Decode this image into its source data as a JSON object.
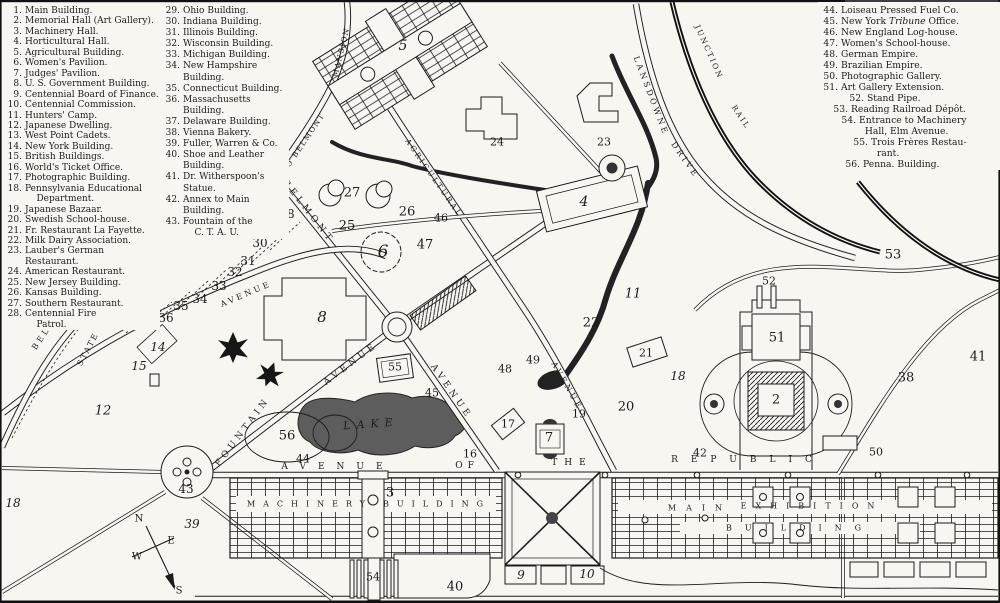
{
  "colors": {
    "ink": "#1c1c1c",
    "paper": "#f7f6f1",
    "water": "#3c3c3c",
    "lake": "#5d5d5d"
  },
  "legend": {
    "col1": [
      {
        "n": "1.",
        "t": "Main Building."
      },
      {
        "n": "2.",
        "t": "Memorial Hall (Art Gallery)."
      },
      {
        "n": "3.",
        "t": "Machinery Hall."
      },
      {
        "n": "4.",
        "t": "Horticultural Hall."
      },
      {
        "n": "5.",
        "t": "Agricultural Building."
      },
      {
        "n": "6.",
        "t": "Women's Pavilion."
      },
      {
        "n": "7.",
        "t": "Judges' Pavilion."
      },
      {
        "n": "8.",
        "t": "U. S. Government Building."
      },
      {
        "n": "9.",
        "t": "Centennial Board of Finance."
      },
      {
        "n": "10.",
        "t": "Centennial Commission."
      },
      {
        "n": "11.",
        "t": "Hunters' Camp."
      },
      {
        "n": "12.",
        "t": "Japanese Dwelling."
      },
      {
        "n": "13.",
        "t": "West Point Cadets."
      },
      {
        "n": "14.",
        "t": "New York Building."
      },
      {
        "n": "15.",
        "t": "British Buildings."
      },
      {
        "n": "16.",
        "t": "World's Ticket Office."
      },
      {
        "n": "17.",
        "t": "Photographic Building."
      },
      {
        "n": "18.",
        "t": "Pennsylvania  Educational\n    Department."
      },
      {
        "n": "19.",
        "t": "Japanese Bazaar."
      },
      {
        "n": "20.",
        "t": "Swedish School-house."
      },
      {
        "n": "21.",
        "t": "Fr. Restaurant La Fayette."
      },
      {
        "n": "22.",
        "t": "Milk Dairy Association."
      },
      {
        "n": "23.",
        "t": "Lauber's German Restaurant."
      },
      {
        "n": "24.",
        "t": "American Restaurant."
      },
      {
        "n": "25.",
        "t": "New Jersey Building."
      },
      {
        "n": "26.",
        "t": "Kansas Building."
      },
      {
        "n": "27.",
        "t": "Southern Restaurant."
      },
      {
        "n": "28.",
        "t": "Centennial  Fire\n    Patrol."
      }
    ],
    "col2": [
      {
        "n": "29.",
        "t": "Ohio Building."
      },
      {
        "n": "30.",
        "t": "Indiana Building."
      },
      {
        "n": "31.",
        "t": "Illinois Building."
      },
      {
        "n": "32.",
        "t": "Wisconsin Building."
      },
      {
        "n": "33.",
        "t": "Michigan Building."
      },
      {
        "n": "34.",
        "t": "New Hampshire Building."
      },
      {
        "n": "35.",
        "t": "Connecticut Building."
      },
      {
        "n": "36.",
        "t": "Massachusetts Building."
      },
      {
        "n": "37.",
        "t": "Delaware Building."
      },
      {
        "n": "38.",
        "t": "Vienna Bakery."
      },
      {
        "n": "39.",
        "t": "Fuller, Warren & Co."
      },
      {
        "n": "40.",
        "t": "Shoe and Leather Building."
      },
      {
        "n": "41.",
        "t": "Dr. Witherspoon's Statue."
      },
      {
        "n": "42.",
        "t": "Annex to Main Building."
      },
      {
        "n": "43.",
        "t": "Fountain  of  the\n    C. T. A. U."
      }
    ],
    "col3": [
      {
        "n": "44.",
        "t": "Loiseau Pressed Fuel Co."
      },
      {
        "n": "45.",
        "t": "New York *Tribune* Office."
      },
      {
        "n": "46.",
        "t": "New England Log-house."
      },
      {
        "n": "47.",
        "t": "Women's School-house."
      },
      {
        "n": "48.",
        "t": "German Empire."
      },
      {
        "n": "49.",
        "t": "Brazilian Empire."
      },
      {
        "n": "50.",
        "t": "Photographic Gallery."
      },
      {
        "n": "51.",
        "t": "Art Gallery Extension."
      },
      {
        "n": "52.",
        "t": "Stand Pipe.",
        "ind": 26
      },
      {
        "n": "53.",
        "t": "Reading Railroad Dépôt.",
        "ind": 10
      },
      {
        "n": "54.",
        "t": "Entrance to Machinery\n  Hall, Elm Avenue.",
        "ind": 18
      },
      {
        "n": "55.",
        "t": "Trois Frères Restau-\n  rant.",
        "ind": 30
      },
      {
        "n": "56.",
        "t": "Penna. Building.",
        "ind": 22
      }
    ]
  },
  "map": {
    "numbers": [
      {
        "v": "5",
        "x": 403,
        "y": 46,
        "fs": 14,
        "it": 1
      },
      {
        "v": "24",
        "x": 497,
        "y": 142
      },
      {
        "v": "23",
        "x": 604,
        "y": 142
      },
      {
        "v": "4",
        "x": 584,
        "y": 202,
        "fs": 14,
        "it": 1
      },
      {
        "v": "27",
        "x": 352,
        "y": 193,
        "fs": 13
      },
      {
        "v": "26",
        "x": 407,
        "y": 212,
        "fs": 13
      },
      {
        "v": "46",
        "x": 441,
        "y": 218
      },
      {
        "v": "25",
        "x": 347,
        "y": 226,
        "fs": 13
      },
      {
        "v": "6",
        "x": 383,
        "y": 252,
        "fs": 17,
        "it": 1
      },
      {
        "v": "47",
        "x": 425,
        "y": 245,
        "fs": 13
      },
      {
        "v": "28",
        "x": 287,
        "y": 214,
        "fs": 12
      },
      {
        "v": "29",
        "x": 271,
        "y": 228,
        "fs": 12
      },
      {
        "v": "30",
        "x": 260,
        "y": 243,
        "fs": 12
      },
      {
        "v": "31",
        "x": 248,
        "y": 261,
        "fs": 12
      },
      {
        "v": "32",
        "x": 235,
        "y": 272,
        "fs": 12
      },
      {
        "v": "33",
        "x": 219,
        "y": 286,
        "fs": 12
      },
      {
        "v": "34",
        "x": 200,
        "y": 299,
        "fs": 12
      },
      {
        "v": "35",
        "x": 181,
        "y": 306,
        "fs": 12
      },
      {
        "v": "36",
        "x": 166,
        "y": 318,
        "fs": 12
      },
      {
        "v": "37",
        "x": 144,
        "y": 321,
        "fs": 12
      },
      {
        "v": "14",
        "x": 158,
        "y": 347,
        "it": 1,
        "fs": 12
      },
      {
        "v": "15",
        "x": 139,
        "y": 366,
        "it": 1,
        "fs": 12
      },
      {
        "v": "12",
        "x": 103,
        "y": 411,
        "it": 1,
        "fs": 13
      },
      {
        "v": "8",
        "x": 322,
        "y": 317,
        "fs": 15,
        "it": 1
      },
      {
        "v": "55",
        "x": 395,
        "y": 367
      },
      {
        "v": "45",
        "x": 432,
        "y": 393
      },
      {
        "v": "56",
        "x": 287,
        "y": 436,
        "fs": 13
      },
      {
        "v": "44",
        "x": 303,
        "y": 459
      },
      {
        "v": "43",
        "x": 186,
        "y": 489,
        "fs": 12
      },
      {
        "v": "39",
        "x": 192,
        "y": 524,
        "it": 1,
        "fs": 12
      },
      {
        "v": "18",
        "x": 13,
        "y": 503,
        "it": 1,
        "fs": 12
      },
      {
        "v": "3",
        "x": 390,
        "y": 493,
        "fs": 13
      },
      {
        "v": "54",
        "x": 373,
        "y": 577
      },
      {
        "v": "40",
        "x": 455,
        "y": 587,
        "fs": 13
      },
      {
        "v": "9",
        "x": 521,
        "y": 575,
        "it": 1,
        "fs": 12
      },
      {
        "v": "10",
        "x": 587,
        "y": 574,
        "it": 1,
        "fs": 12
      },
      {
        "v": "16",
        "x": 470,
        "y": 454
      },
      {
        "v": "17",
        "x": 508,
        "y": 424
      },
      {
        "v": "7",
        "x": 549,
        "y": 438,
        "fs": 13
      },
      {
        "v": "19",
        "x": 579,
        "y": 414
      },
      {
        "v": "20",
        "x": 626,
        "y": 407,
        "fs": 13
      },
      {
        "v": "21",
        "x": 646,
        "y": 353
      },
      {
        "v": "22",
        "x": 591,
        "y": 323,
        "fs": 13
      },
      {
        "v": "11",
        "x": 633,
        "y": 294,
        "it": 1,
        "fs": 13
      },
      {
        "v": "18",
        "x": 678,
        "y": 376,
        "it": 1,
        "fs": 12
      },
      {
        "v": "48",
        "x": 505,
        "y": 369
      },
      {
        "v": "49",
        "x": 533,
        "y": 360
      },
      {
        "v": "2",
        "x": 776,
        "y": 400,
        "fs": 13
      },
      {
        "v": "51",
        "x": 777,
        "y": 338,
        "fs": 13
      },
      {
        "v": "52",
        "x": 769,
        "y": 281
      },
      {
        "v": "50",
        "x": 876,
        "y": 452
      },
      {
        "v": "42",
        "x": 700,
        "y": 453
      },
      {
        "v": "38",
        "x": 906,
        "y": 378,
        "fs": 13
      },
      {
        "v": "41",
        "x": 978,
        "y": 357,
        "fs": 13
      },
      {
        "v": "53",
        "x": 893,
        "y": 255,
        "fs": 13
      }
    ],
    "labels": [
      {
        "t": "MACHINERY",
        "x": 310,
        "y": 504,
        "rot": 0,
        "ls": 8,
        "fs": 8
      },
      {
        "t": "BUILDING",
        "x": 437,
        "y": 504,
        "rot": 0,
        "ls": 8,
        "fs": 8
      },
      {
        "t": "MAIN",
        "x": 700,
        "y": 508,
        "rot": 0,
        "ls": 10,
        "fs": 8
      },
      {
        "t": "EXHIBITION",
        "x": 812,
        "y": 506,
        "rot": 0,
        "ls": 9,
        "fs": 8
      },
      {
        "t": "BUILDING",
        "x": 800,
        "y": 528,
        "rot": 0,
        "ls": 13,
        "fs": 8
      },
      {
        "t": "AVENUE",
        "x": 338,
        "y": 467,
        "rot": 0,
        "ls": 12,
        "fs": 9
      },
      {
        "t": "OF",
        "x": 467,
        "y": 466,
        "rot": 0,
        "ls": 5,
        "fs": 9
      },
      {
        "t": "THE",
        "x": 572,
        "y": 463,
        "rot": 0,
        "ls": 7,
        "fs": 9
      },
      {
        "t": "REPUBLIC",
        "x": 748,
        "y": 460,
        "rot": 0,
        "ls": 13,
        "fs": 9
      },
      {
        "t": "LAKE",
        "x": 371,
        "y": 424,
        "rot": -4,
        "ls": 6,
        "fs": 11,
        "it": 1
      },
      {
        "t": "FOUNTAIN",
        "x": 243,
        "y": 432,
        "rot": -53,
        "ls": 4,
        "fs": 9
      },
      {
        "t": "AVENUE",
        "x": 351,
        "y": 364,
        "rot": -37,
        "ls": 4,
        "fs": 9
      },
      {
        "t": "BELMONT",
        "x": 308,
        "y": 212,
        "rot": 52,
        "ls": 4,
        "fs": 9
      },
      {
        "t": "AVENUE",
        "x": 451,
        "y": 392,
        "rot": 55,
        "ls": 4,
        "fs": 9
      },
      {
        "t": "AVENUE",
        "x": 567,
        "y": 386,
        "rot": 60,
        "ls": 3,
        "fs": 8
      },
      {
        "t": "AGRICULTURAL",
        "x": 434,
        "y": 178,
        "rot": 55,
        "ls": 2.5,
        "fs": 7.5
      },
      {
        "t": "LANSDOWNE",
        "x": 651,
        "y": 96,
        "rot": 69,
        "ls": 3,
        "fs": 8
      },
      {
        "t": "DRIVE",
        "x": 685,
        "y": 160,
        "rot": 55,
        "ls": 3,
        "fs": 8
      },
      {
        "t": "JUNCTION",
        "x": 709,
        "y": 52,
        "rot": 66,
        "ls": 2,
        "fs": 7.5
      },
      {
        "t": "RAIL",
        "x": 741,
        "y": 117,
        "rot": 56,
        "ls": 2,
        "fs": 7.5
      },
      {
        "t": "ROAD",
        "x": 858,
        "y": 36,
        "rot": 72,
        "ls": 2,
        "fs": 7.5
      },
      {
        "t": "DRIVE TO BELMONT",
        "x": 293,
        "y": 158,
        "rot": -56,
        "ls": 1.5,
        "fs": 7.5
      },
      {
        "t": "MANSION",
        "x": 341,
        "y": 52,
        "rot": -76,
        "ls": 1.5,
        "fs": 7.5
      },
      {
        "t": "BELMONT",
        "x": 52,
        "y": 322,
        "rot": -56,
        "ls": 3,
        "fs": 8
      },
      {
        "t": "DRIVE",
        "x": 112,
        "y": 290,
        "rot": -38,
        "ls": 3,
        "fs": 8
      },
      {
        "t": "STATE",
        "x": 88,
        "y": 349,
        "rot": -62,
        "ls": 2,
        "fs": 8
      },
      {
        "t": "AVENUE",
        "x": 246,
        "y": 294,
        "rot": -23,
        "ls": 3,
        "fs": 8
      },
      {
        "t": "N",
        "x": 139,
        "y": 519,
        "rot": 0,
        "ls": 0,
        "fs": 10
      },
      {
        "t": "E",
        "x": 171,
        "y": 541,
        "rot": 0,
        "ls": 0,
        "fs": 10
      },
      {
        "t": "W",
        "x": 137,
        "y": 557,
        "rot": 0,
        "ls": 0,
        "fs": 10
      },
      {
        "t": "S",
        "x": 179,
        "y": 591,
        "rot": 0,
        "ls": 0,
        "fs": 10
      }
    ]
  }
}
